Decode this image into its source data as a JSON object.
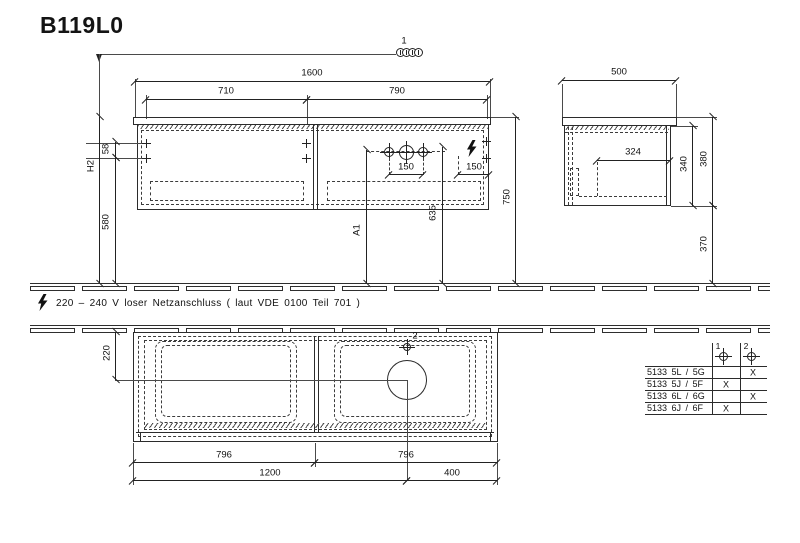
{
  "title": "B119L0",
  "colors": {
    "line": "#2b2b2b",
    "text": "#111111",
    "background": "#ffffff"
  },
  "marker_top": {
    "label": "1"
  },
  "front_view": {
    "dims": {
      "overall_width": "1600",
      "left_opening": "710",
      "right_opening": "790",
      "top_offset": "58",
      "height_reference": "H2",
      "bottom_height": "580",
      "worktop_height": "750",
      "drain_height": "635",
      "basin_ref": "A1",
      "hole_pitch_left": "150",
      "hole_pitch_right": "150"
    }
  },
  "side_view": {
    "dims": {
      "depth": "500",
      "inner_depth": "324",
      "body_height": "340",
      "overall_height": "380",
      "clearance_below": "370"
    }
  },
  "electrical_note": "220 – 240 V loser Netzanschluss ( laut VDE 0100 Teil 701 )",
  "plan_view": {
    "dims": {
      "drain_from_wall": "220",
      "hole_marker": "2",
      "left_width": "796",
      "right_width": "796",
      "width_to_drain": "1200",
      "right_offset": "400"
    }
  },
  "variant_table": {
    "headers": [
      "1",
      "2"
    ],
    "rows": [
      {
        "model": "5133 5L / 5G",
        "c1": "",
        "c2": "X"
      },
      {
        "model": "5133 5J / 5F",
        "c1": "X",
        "c2": ""
      },
      {
        "model": "5133 6L / 6G",
        "c1": "",
        "c2": "X"
      },
      {
        "model": "5133 6J / 6F",
        "c1": "X",
        "c2": ""
      }
    ]
  }
}
